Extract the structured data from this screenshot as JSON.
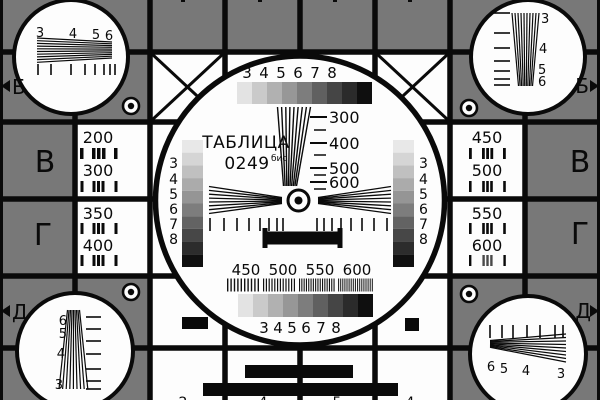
{
  "card": {
    "title": "ТАБЛИЦА",
    "number": "0249",
    "suffix": "бис"
  },
  "colors": {
    "background": "#787878",
    "line": "#0a0a0a",
    "white": "#fdfdfd",
    "steps9": [
      "#e3e3e3",
      "#cacaca",
      "#b1b1b1",
      "#979797",
      "#7d7d7d",
      "#606060",
      "#454545",
      "#2b2b2b",
      "#0f0f0f"
    ],
    "steps10": [
      "#e8e8e8",
      "#d5d5d5",
      "#c0c0c0",
      "#ababab",
      "#959595",
      "#7d7d7d",
      "#636363",
      "#474747",
      "#2c2c2c",
      "#101010"
    ]
  },
  "letters": {
    "b": "Б",
    "v": "В",
    "g": "Г",
    "d": "Д"
  },
  "corner_numbers": {
    "top_left": [
      "3",
      "4",
      "5",
      "6"
    ],
    "top_right": [
      "3",
      "4",
      "5",
      "6"
    ],
    "bottom_left": [
      "6",
      "5",
      "4",
      "3"
    ],
    "bottom_right": [
      "6",
      "5",
      "4",
      "3"
    ]
  },
  "center_scales": {
    "gray_steps_labels": [
      "3",
      "4",
      "5",
      "6",
      "7",
      "8"
    ],
    "vertical_wedge_labels": [
      "300",
      "400",
      "500",
      "600"
    ],
    "burst_labels": [
      "450",
      "500",
      "550",
      "600"
    ]
  },
  "frequency_cells": {
    "left_top": [
      "200",
      "300"
    ],
    "left_bottom": [
      "350",
      "400"
    ],
    "right_top": [
      "450",
      "500"
    ],
    "right_bottom": [
      "550",
      "600"
    ]
  },
  "bottom_edge_digits": [
    "2",
    "4",
    "5",
    "4"
  ]
}
